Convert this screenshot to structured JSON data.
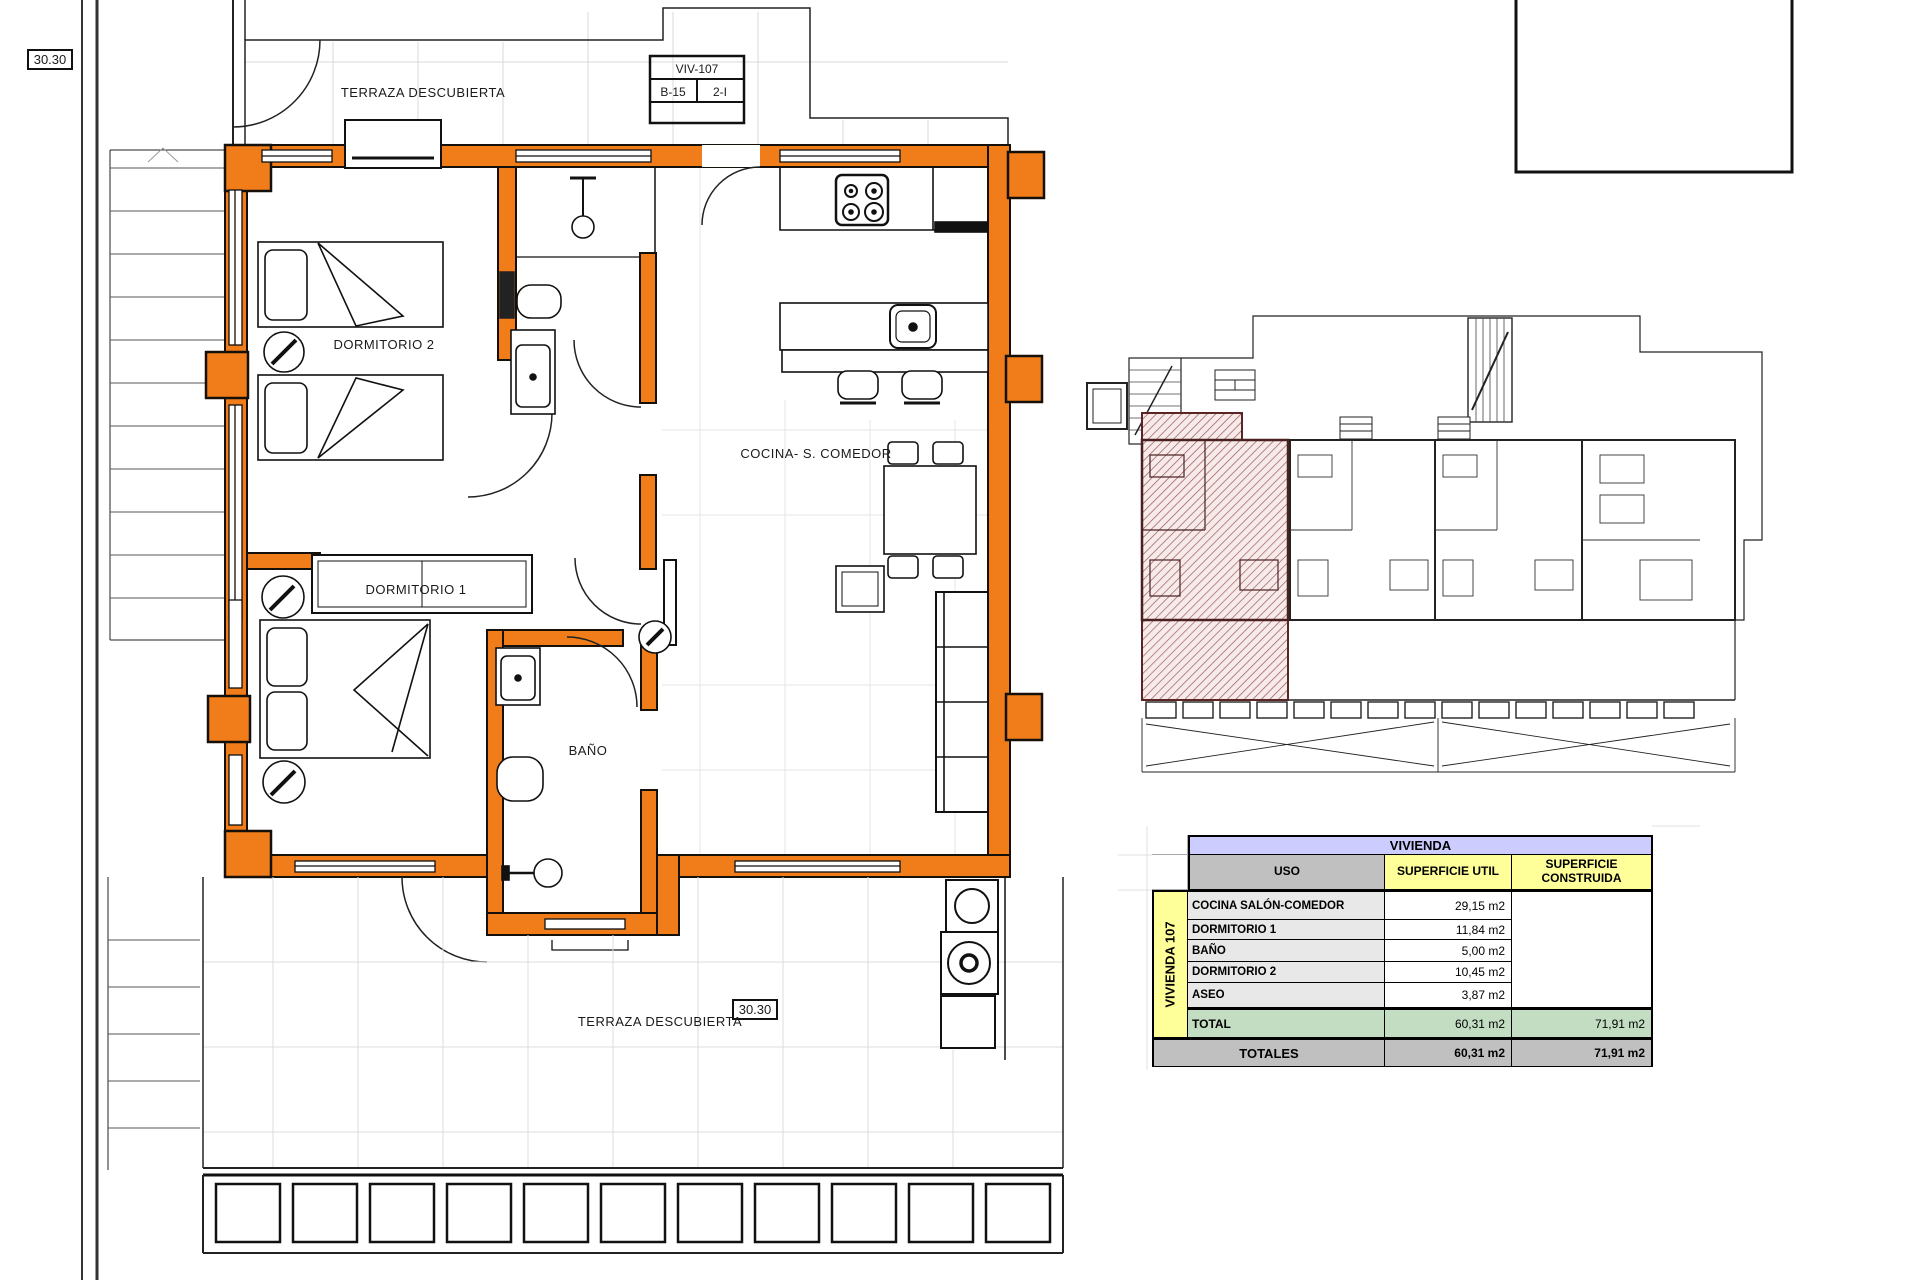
{
  "colors": {
    "wall_orange": "#F07D1A",
    "hatch_pink_line": "#A05858",
    "table_title_lavender": "#CCCCFF",
    "table_header_gray": "#C0C0C0",
    "table_header_yellow": "#FFFF99",
    "table_total_green": "#C3DDC3"
  },
  "dims": {
    "top_left": "30.30",
    "entry": "30.35",
    "bottom_terrace": "30.30"
  },
  "title_block": {
    "unit": "VIV-107",
    "block": "B-15",
    "floor": "2-I"
  },
  "rooms": {
    "terraza_top": "TERRAZA DESCUBIERTA",
    "dormitorio2": "DORMITORIO 2",
    "dormitorio1": "DORMITORIO 1",
    "bano": "BAÑO",
    "cocina": "COCINA- S. COMEDOR",
    "terraza_bottom": "TERRAZA DESCUBIERTA"
  },
  "summary_table": {
    "title": "VIVIENDA",
    "group_label": "VIVIENDA 107",
    "col_uso": "USO",
    "col_util": "SUPERFICIE UTIL",
    "col_construida": "SUPERFICIE CONSTRUIDA",
    "rows": [
      {
        "uso": "COCINA SALÓN-COMEDOR",
        "util": "29,15 m2"
      },
      {
        "uso": "DORMITORIO 1",
        "util": "11,84 m2"
      },
      {
        "uso": "BAÑO",
        "util": "5,00 m2"
      },
      {
        "uso": "DORMITORIO 2",
        "util": "10,45 m2"
      },
      {
        "uso": "ASEO",
        "util": "3,87 m2"
      }
    ],
    "total": {
      "label": "TOTAL",
      "util": "60,31 m2",
      "construida": "71,91 m2"
    },
    "totales": {
      "label": "TOTALES",
      "util": "60,31 m2",
      "construida": "71,91 m2"
    }
  }
}
